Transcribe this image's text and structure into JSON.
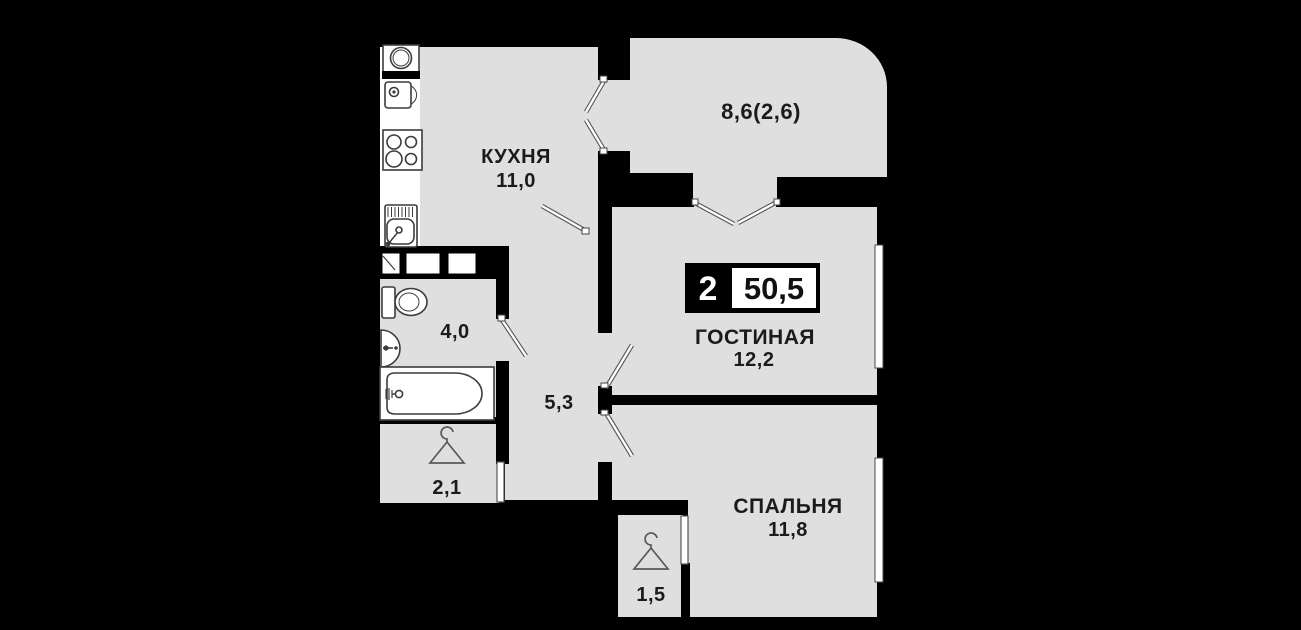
{
  "title": "apartment-floor-plan",
  "colors": {
    "background": "#000000",
    "floor": "#dfdfdf",
    "wall": "#000000",
    "fixture_outline": "#3c3c3c",
    "door_leaf": "#ffffff",
    "text": "#1b1b1b",
    "badge_background": "#000000",
    "badge_box": "#ffffff"
  },
  "badge": {
    "room_count": "2",
    "total_area": "50,5"
  },
  "rooms": {
    "kitchen": {
      "label": "КУХНЯ",
      "area": "11,0"
    },
    "balcony": {
      "area": "8,6(2,6)"
    },
    "living": {
      "label": "ГОСТИНАЯ",
      "area": "12,2"
    },
    "bedroom": {
      "label": "СПАЛЬНЯ",
      "area": "11,8"
    },
    "bathroom": {
      "area": "4,0"
    },
    "hallway": {
      "area": "5,3"
    },
    "wardrobe": {
      "area": "2,1"
    },
    "closet": {
      "area": "1,5"
    }
  },
  "icons": {
    "kitchen": [
      "washing-machine-icon",
      "fridge-icon",
      "stove-icon",
      "kitchen-sink-icon",
      "cabinet-row"
    ],
    "bathroom": [
      "toilet-icon",
      "washbasin-icon",
      "bathtub-icon"
    ],
    "wardrobe": "hanger-icon",
    "closet": "hanger-icon"
  }
}
